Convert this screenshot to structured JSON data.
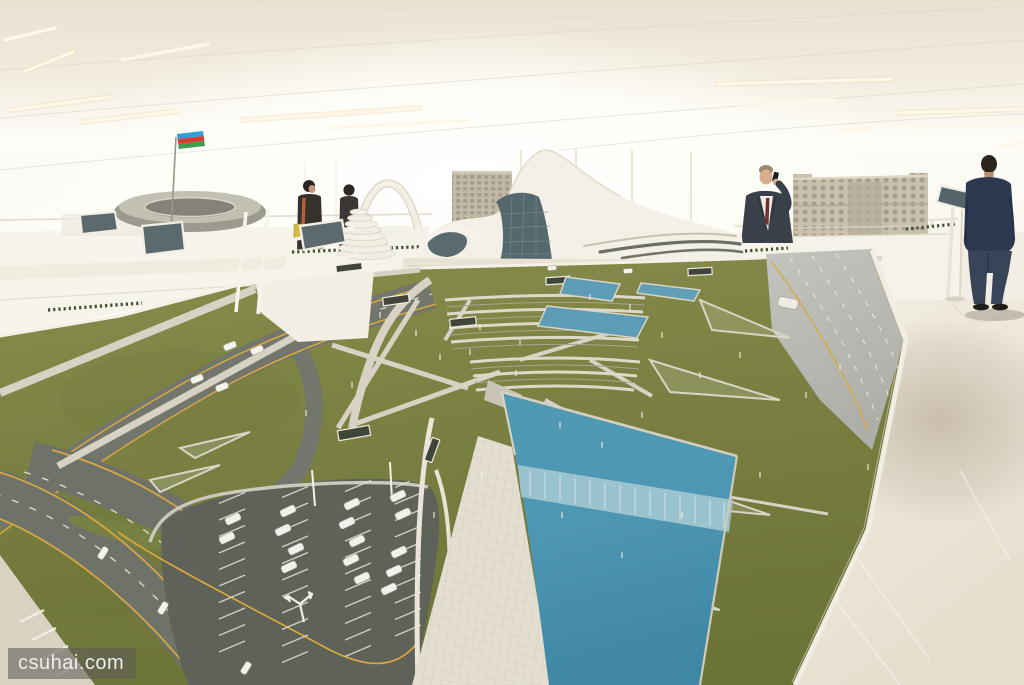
{
  "image": {
    "type": "photograph",
    "subject": "Architectural scale model of the Heydar Aliyev Center and its landscaped site displayed on white exhibition tables in a bright, curved white hall"
  },
  "watermark": {
    "text": "csuhai.com"
  },
  "palette": {
    "ceiling": "#f1ebdf",
    "glare": "#fffdf8",
    "lawn_light": "#868b4a",
    "lawn_dark": "#6d7438",
    "pool_blue": "#4f9ab2",
    "waterfall": "#a3c8d1",
    "asphalt_parking": "#5f6258",
    "road_gray": "#6c6f66",
    "highway_gray": "#b7b8b0",
    "lane_yellow": "#d8a93f",
    "path_light": "#d5d0c1",
    "floor_light": "#f0ebe0",
    "floor_shadow": "#c9c0ae",
    "model_white": "#f4f0e7",
    "glass_teal": "#55686e",
    "stone_beige": "#c5bdaa",
    "flag_blue": "#2f9ed6",
    "flag_red": "#da3a34",
    "flag_green": "#3f9e4d",
    "suit": "#394049",
    "navy_shirt": "#2d3950",
    "jeans": "#3a4458",
    "hedge_green": "#44502d"
  },
  "scene": {
    "flag": "azerbaijan-flag",
    "models": [
      "stadium",
      "spiral-tower",
      "heydar-aliyev-center",
      "government-house",
      "city-blocks"
    ],
    "people": [
      {
        "id": "visitor-1",
        "desc": "visitor with orange scarf and yellow bag"
      },
      {
        "id": "visitor-2",
        "desc": "visitor in dark clothes"
      },
      {
        "id": "man-on-phone",
        "desc": "man in dark suit talking on a phone"
      },
      {
        "id": "standing-man",
        "desc": "man in navy shirt and jeans seen from behind"
      }
    ],
    "parking_car_count": 16,
    "road_car_count": 7,
    "van_count": 1
  },
  "cars": {
    "parking_angle": -25,
    "parking": [
      [
        233,
        519
      ],
      [
        227,
        538
      ],
      [
        288,
        511
      ],
      [
        283,
        530
      ],
      [
        296,
        549
      ],
      [
        289,
        567
      ],
      [
        352,
        504
      ],
      [
        347,
        523
      ],
      [
        357,
        541
      ],
      [
        351,
        560
      ],
      [
        362,
        578
      ],
      [
        398,
        496
      ],
      [
        403,
        514
      ],
      [
        399,
        552
      ],
      [
        394,
        571
      ],
      [
        389,
        589
      ]
    ],
    "roads": [
      [
        103,
        553,
        -58
      ],
      [
        163,
        608,
        -58
      ],
      [
        246,
        668,
        -58
      ],
      [
        230,
        346,
        -22
      ],
      [
        257,
        350,
        -22
      ],
      [
        197,
        379,
        -22
      ],
      [
        222,
        387,
        -22
      ]
    ],
    "plaza": [
      [
        552,
        268,
        -5
      ],
      [
        628,
        271,
        -3
      ]
    ],
    "van": [
      788,
      303,
      12
    ]
  }
}
